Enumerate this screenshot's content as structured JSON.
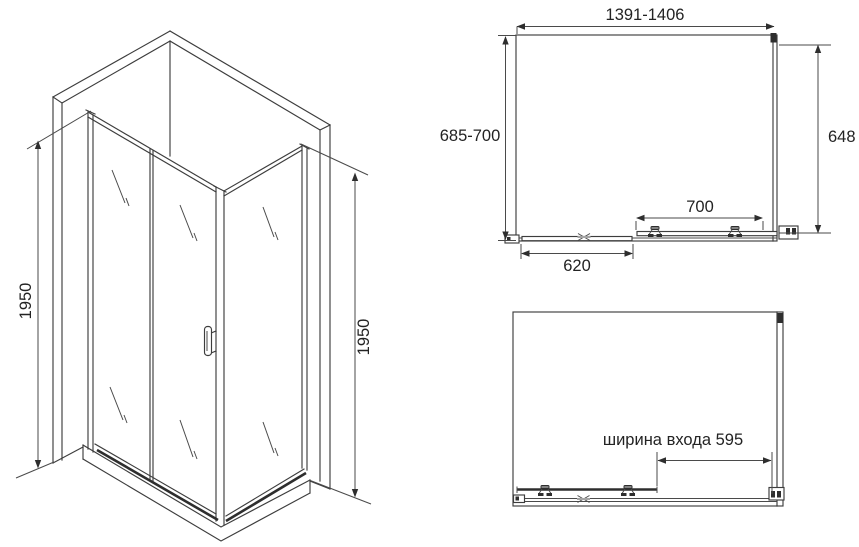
{
  "iso_view": {
    "height_left": "1950",
    "height_right": "1950"
  },
  "top_view": {
    "width_range": "1391-1406",
    "depth_range": "685-700",
    "right_depth": "648",
    "panel_width": "700",
    "door_width": "620"
  },
  "open_view": {
    "entrance_width": "ширина входа 595"
  },
  "colors": {
    "line": "#3d3d3d",
    "text": "#232323",
    "background": "#ffffff"
  }
}
